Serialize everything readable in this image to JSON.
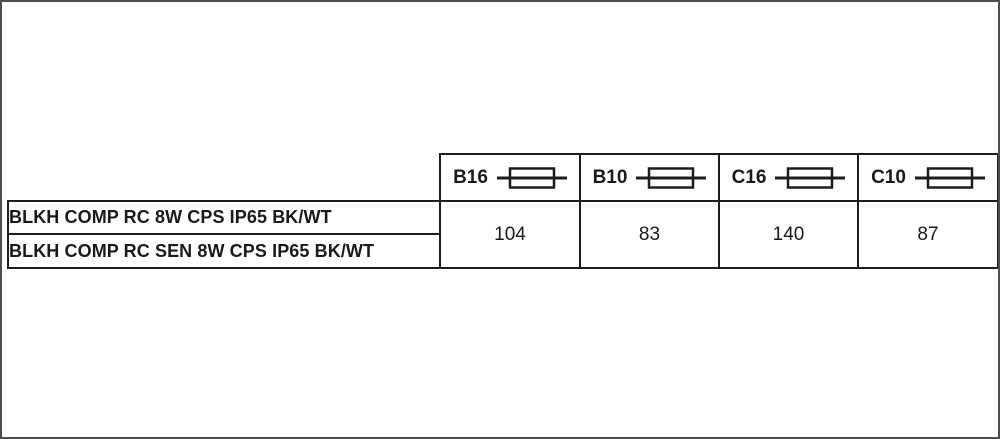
{
  "page": {
    "background_color": "#ffffff",
    "frame_border_color": "#4d4d4d"
  },
  "table": {
    "border_color": "#1d1d1b",
    "text_color": "#1a1a1a",
    "headers": [
      {
        "label": "B16",
        "icon": "fuse-icon"
      },
      {
        "label": "B10",
        "icon": "fuse-icon"
      },
      {
        "label": "C16",
        "icon": "fuse-icon"
      },
      {
        "label": "C10",
        "icon": "fuse-icon"
      }
    ],
    "products": [
      {
        "name": "BLKH COMP RC 8W CPS IP65 BK/WT"
      },
      {
        "name": "BLKH COMP RC SEN 8W CPS IP65 BK/WT"
      }
    ],
    "values": [
      {
        "value": "104"
      },
      {
        "value": "83"
      },
      {
        "value": "140"
      },
      {
        "value": "87"
      }
    ]
  }
}
